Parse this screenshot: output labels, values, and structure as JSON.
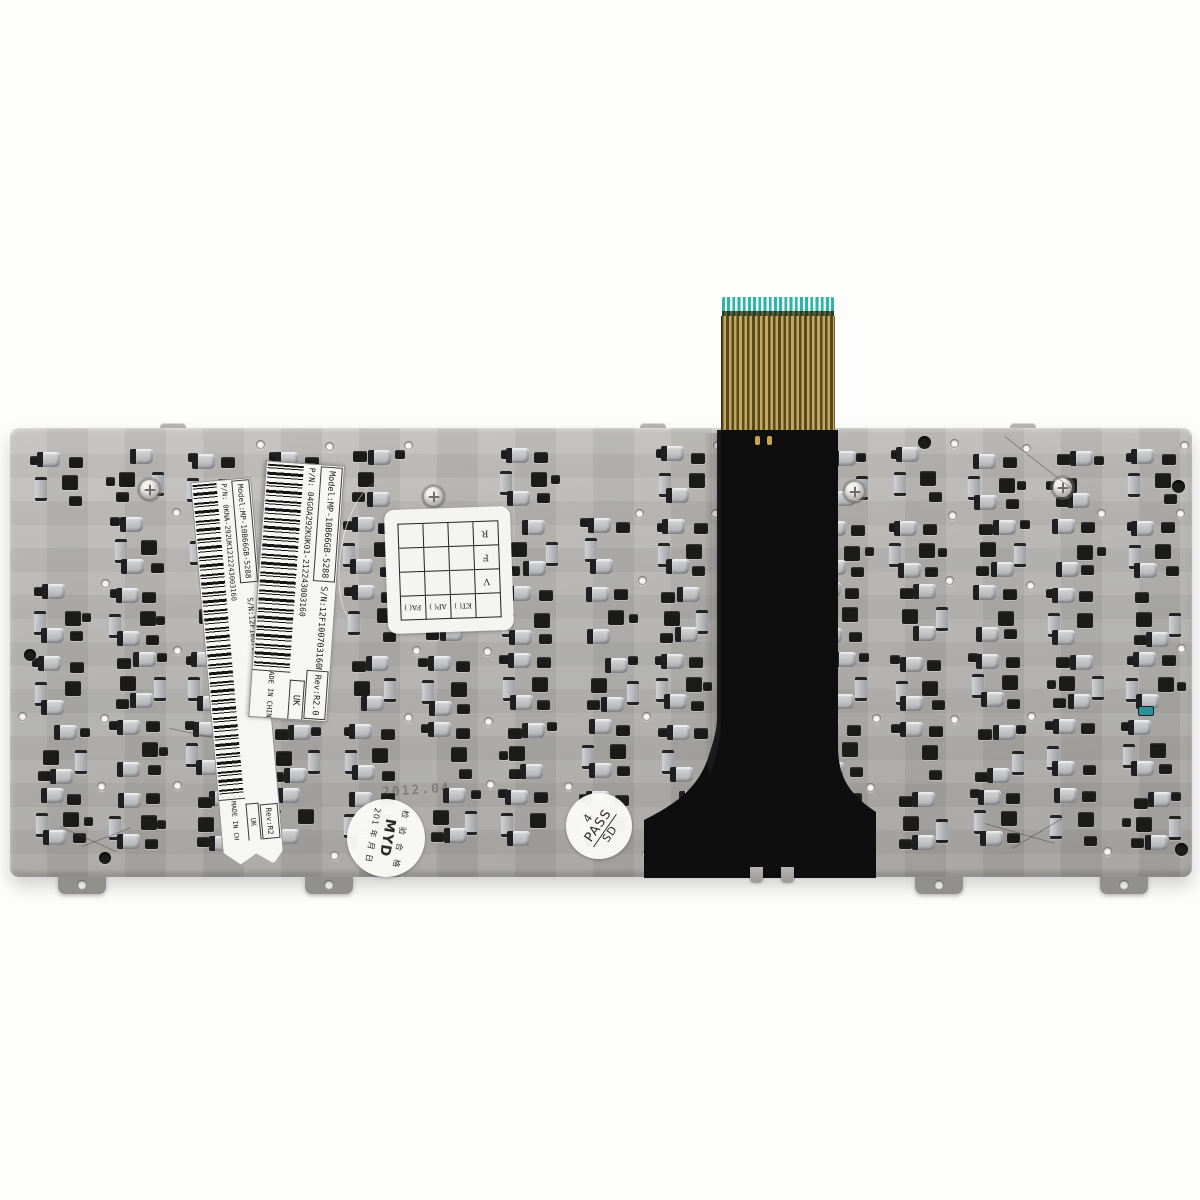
{
  "photo": {
    "subject": "laptop keyboard rear metal backplate with flex ribbon cable",
    "background_color": "#fdfdfc",
    "plate_color": "#b2b1ae",
    "cable_color": "#0e0e0e",
    "connector_tip_color": "#35b2a6",
    "trace_colors": [
      "#564a1e",
      "#c3a75e"
    ]
  },
  "labels": {
    "inner": {
      "model": "Model:MP-10B66GB-5288",
      "serial": "S/N:12F100703160M",
      "revision": "Rev:R2.0",
      "part_number": "P/N:  04GOA292KUK01-212243003160",
      "country": "MADE IN CHINA",
      "region": "UK"
    },
    "outer": {
      "model": "Model:MP-10B66GB-5288",
      "serial": "S/N:12F100703160M",
      "revision": "Rev:R2",
      "part_number": "P/N:  0KNA-292UK1212243003160",
      "country": "MADE IN CH",
      "region": "UK"
    }
  },
  "qc_grid_sticker": {
    "rows": 4,
    "cols": 4,
    "side_labels": [
      "R",
      "F",
      "V"
    ],
    "bottom_labels": [
      "FA(  )",
      "AP(  )",
      "KT(  )"
    ],
    "orientation": "upside-down"
  },
  "stamps": {
    "pass": {
      "line1": "4",
      "line2": "PASS",
      "line3": "SD"
    },
    "inspector": {
      "arc_text": "检 验 合 格",
      "code": "MYD",
      "code_color": "#bf3a2f",
      "date_text": "201   年  月  日"
    }
  },
  "ghost_text": "2012.04",
  "pattern": {
    "rows": 6,
    "cols": 15,
    "seed": 13
  }
}
